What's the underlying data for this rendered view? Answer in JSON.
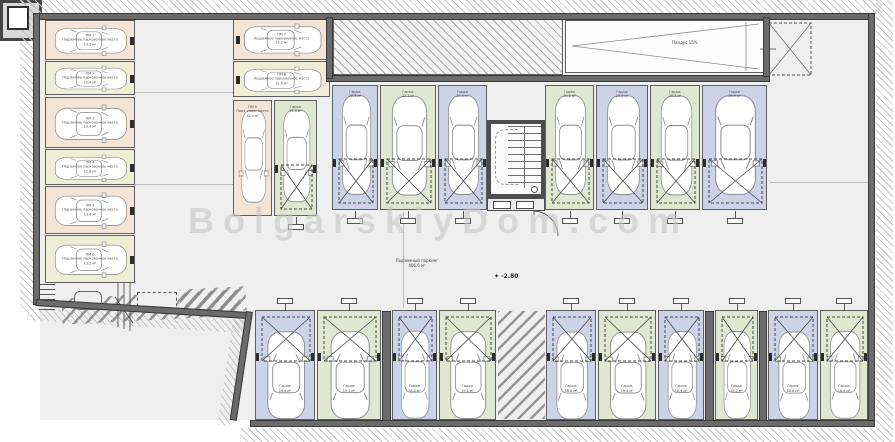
{
  "plan": {
    "watermark": "BolgarskiyDom.com",
    "hall_label": "Подземный паркинг",
    "hall_area": "406.6 м²",
    "level_symbol": "✦",
    "level": "-2.80",
    "ramp_label": "Пандус 15%",
    "garage_label": "Гараж"
  },
  "colors": {
    "floor": "#efeff0",
    "wall": "#6b6b6b",
    "pink": "#f4e4d6",
    "green_h": "#edeed5",
    "lavender": "#ccd2e7",
    "green_v": "#dfe7d1",
    "watermark": "#c7c7c7"
  },
  "spots": [
    {
      "id": "L1",
      "x": 45,
      "y": 20,
      "w": 90,
      "h": 40,
      "color": "pink",
      "dir": "right",
      "swing": false,
      "tick": "right",
      "lines": [
        "ПМ 1",
        "Подземное парковочное место",
        "13.2 м²"
      ]
    },
    {
      "id": "L2",
      "x": 45,
      "y": 61,
      "w": 90,
      "h": 34,
      "color": "green_h",
      "dir": "right",
      "swing": false,
      "tick": "right",
      "lines": [
        "ПМ 2",
        "Подземное парковочное место",
        "12.8 м²"
      ]
    },
    {
      "id": "L3",
      "x": 45,
      "y": 97,
      "w": 90,
      "h": 51,
      "color": "pink",
      "dir": "right",
      "swing": false,
      "tick": "right",
      "lines": [
        "ПМ 3",
        "Подземное парковочное место",
        "13.4 м²"
      ]
    },
    {
      "id": "L4",
      "x": 45,
      "y": 149,
      "w": 90,
      "h": 36,
      "color": "green_h",
      "dir": "right",
      "swing": false,
      "tick": "right",
      "lines": [
        "ПМ 4",
        "Подземное парковочное место",
        "12.8 м²"
      ]
    },
    {
      "id": "L5",
      "x": 45,
      "y": 186,
      "w": 90,
      "h": 48,
      "color": "pink",
      "dir": "right",
      "swing": false,
      "tick": "right",
      "lines": [
        "ПМ 5",
        "Подземное парковочное место",
        "13.4 м²"
      ]
    },
    {
      "id": "L6",
      "x": 45,
      "y": 235,
      "w": 90,
      "h": 48,
      "color": "green_h",
      "dir": "right",
      "swing": false,
      "tick": "right",
      "lines": [
        "ПМ 6",
        "Подземное парковочное место",
        "13.2 м²"
      ]
    },
    {
      "id": "A",
      "x": 233,
      "y": 17,
      "w": 97,
      "h": 43,
      "color": "pink",
      "dir": "right",
      "swing": false,
      "tick": "left",
      "lines": [
        "ПМ 7",
        "Подземное парковочное место",
        "13.2 м²"
      ]
    },
    {
      "id": "B",
      "x": 233,
      "y": 61,
      "w": 97,
      "h": 36,
      "color": "green_h",
      "dir": "right",
      "swing": false,
      "tick": "left",
      "lines": [
        "ПМ 8",
        "Подземное парковочное место",
        "12.8 м²"
      ]
    },
    {
      "id": "C",
      "x": 233,
      "y": 100,
      "w": 39,
      "h": 116,
      "color": "pink",
      "dir": "down",
      "swing": false,
      "lines": [
        "ПМ 9",
        "Подз. парк. место",
        "13.4 м²"
      ]
    },
    {
      "id": "D",
      "x": 274,
      "y": 100,
      "w": 43,
      "h": 116,
      "color": "green_v",
      "dir": "down",
      "swing": true,
      "lines": [
        "Гараж",
        "13.4 м²"
      ]
    },
    {
      "id": "U1",
      "x": 332,
      "y": 85,
      "w": 46,
      "h": 125,
      "color": "lavender",
      "dir": "down",
      "swing": true,
      "lines": [
        "Гараж",
        "20.3 м²"
      ]
    },
    {
      "id": "U2",
      "x": 380,
      "y": 85,
      "w": 56,
      "h": 125,
      "color": "green_v",
      "dir": "down",
      "swing": true,
      "lines": [
        "Гараж",
        "22.1 м²"
      ]
    },
    {
      "id": "U3",
      "x": 438,
      "y": 85,
      "w": 49,
      "h": 125,
      "color": "lavender",
      "dir": "down",
      "swing": true,
      "lines": [
        "Гараж",
        "20.5 м²"
      ]
    },
    {
      "id": "U4",
      "x": 545,
      "y": 85,
      "w": 49,
      "h": 125,
      "color": "green_v",
      "dir": "down",
      "swing": true,
      "lines": [
        "Гараж",
        "20.1 м²"
      ]
    },
    {
      "id": "U5",
      "x": 596,
      "y": 85,
      "w": 52,
      "h": 125,
      "color": "lavender",
      "dir": "down",
      "swing": true,
      "lines": [
        "Гараж",
        "20.9 м²"
      ]
    },
    {
      "id": "U6",
      "x": 650,
      "y": 85,
      "w": 50,
      "h": 125,
      "color": "green_v",
      "dir": "down",
      "swing": true,
      "lines": [
        "Гараж",
        "20.3 м²"
      ]
    },
    {
      "id": "U7",
      "x": 702,
      "y": 85,
      "w": 65,
      "h": 125,
      "color": "lavender",
      "dir": "down",
      "swing": true,
      "lines": [
        "Гараж",
        "26.9 м²"
      ]
    },
    {
      "id": "B1",
      "x": 255,
      "y": 310,
      "w": 60,
      "h": 110,
      "color": "lavender",
      "dir": "up",
      "swing": true,
      "lines": [
        "Гараж",
        "18.6 м²"
      ]
    },
    {
      "id": "B2",
      "x": 317,
      "y": 310,
      "w": 64,
      "h": 110,
      "color": "green_v",
      "dir": "up",
      "swing": true,
      "lines": [
        "Гараж",
        "19.7 м²"
      ]
    },
    {
      "id": "B3",
      "x": 392,
      "y": 310,
      "w": 45,
      "h": 110,
      "color": "lavender",
      "dir": "up",
      "swing": true,
      "lines": [
        "Гараж",
        "18.4 м²"
      ]
    },
    {
      "id": "B4",
      "x": 439,
      "y": 310,
      "w": 57,
      "h": 110,
      "color": "green_v",
      "dir": "up",
      "swing": true,
      "lines": [
        "Гараж",
        "19.1 м²"
      ]
    },
    {
      "id": "B5",
      "x": 546,
      "y": 310,
      "w": 50,
      "h": 110,
      "color": "lavender",
      "dir": "up",
      "swing": true,
      "lines": [
        "Гараж",
        "18.6 м²"
      ]
    },
    {
      "id": "B6",
      "x": 598,
      "y": 310,
      "w": 58,
      "h": 110,
      "color": "green_v",
      "dir": "up",
      "swing": true,
      "lines": [
        "Гараж",
        "19.4 м²"
      ]
    },
    {
      "id": "B7",
      "x": 658,
      "y": 310,
      "w": 46,
      "h": 110,
      "color": "lavender",
      "dir": "up",
      "swing": true,
      "lines": [
        "Гараж",
        "18.4 м²"
      ]
    },
    {
      "id": "B8",
      "x": 715,
      "y": 310,
      "w": 43,
      "h": 110,
      "color": "green_v",
      "dir": "up",
      "swing": true,
      "lines": [
        "Гараж",
        "18.2 м²"
      ]
    },
    {
      "id": "B9",
      "x": 768,
      "y": 310,
      "w": 50,
      "h": 110,
      "color": "lavender",
      "dir": "up",
      "swing": true,
      "lines": [
        "Гараж",
        "18.8 м²"
      ]
    },
    {
      "id": "B10",
      "x": 820,
      "y": 310,
      "w": 48,
      "h": 110,
      "color": "green_v",
      "dir": "up",
      "swing": true,
      "lines": [
        "Гараж",
        "18.6 м²"
      ]
    }
  ]
}
